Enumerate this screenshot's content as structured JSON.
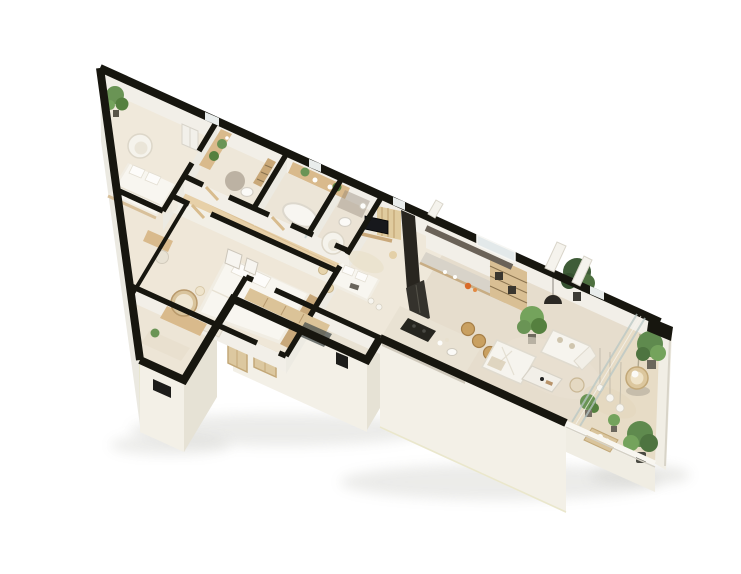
{
  "scene": {
    "kind": "isometric-3d-apartment-floor-plan-render",
    "background": "#ffffff"
  },
  "palette": {
    "wall_cut": "#17160f",
    "wall_face_light": "#f3f0e7",
    "wall_face_shade": "#e6e2d5",
    "wall_face_inner": "#f2efe8",
    "floor_cream": "#f0e9db",
    "floor_bath": "#ece5d7",
    "floor_living": "#e6ddcd",
    "floor_balcony": "#e7dcc6",
    "floor_corridor": "#e7d0a8",
    "wood_light": "#d9ba8c",
    "wood_door": "#dcc8a0",
    "wood_cabinet": "#d9bf94",
    "white_furniture": "#f6f4ee",
    "dark_appliance": "#34322c",
    "tv_screen": "#17181c",
    "plant_green": "#6a9455",
    "plant_dark": "#3f5c38",
    "accent_orange": "#d96a28",
    "glass": "#b9c7c5",
    "shadow": "#9a9a93"
  },
  "rooms": [
    {
      "id": "bedroom-apex",
      "furniture": [
        "double-bed",
        "armchair",
        "wardrobe",
        "plant"
      ]
    },
    {
      "id": "bathroom-1",
      "furniture": [
        "wood-vanity",
        "plants",
        "ladder-shelf",
        "wc",
        "stone-floor-mat"
      ]
    },
    {
      "id": "bathroom-2",
      "furniture": [
        "double-vanity",
        "plants",
        "bathtub",
        "glass-shower"
      ]
    },
    {
      "id": "wc",
      "furniture": [
        "toilet",
        "basin"
      ]
    },
    {
      "id": "corridor",
      "furniture": [
        "wood-plank-floor"
      ]
    },
    {
      "id": "bedroom-2",
      "furniture": [
        "double-bed",
        "headboard",
        "wall-art",
        "bench",
        "desk",
        "chair"
      ]
    },
    {
      "id": "dressing-hall",
      "furniture": [
        "console",
        "round-mirror",
        "runner-rug"
      ]
    },
    {
      "id": "entry-vestibule",
      "furniture": [
        "door-mat",
        "closet-row"
      ]
    },
    {
      "id": "master-bedroom",
      "furniture": [
        "media-wall",
        "tv",
        "slat-panel",
        "armchair",
        "bed",
        "rug",
        "floor-lamps"
      ]
    },
    {
      "id": "kitchen",
      "furniture": [
        "counter",
        "fridge",
        "tall-cabinets",
        "island",
        "cooktop",
        "bar-stools",
        "plant"
      ]
    },
    {
      "id": "living-room",
      "furniture": [
        "sofa",
        "l-sofa",
        "coffee-table",
        "side-table",
        "pendant-lamp",
        "tall-plant",
        "rug"
      ]
    },
    {
      "id": "balcony",
      "furniture": [
        "hanging-chair",
        "potted-plants",
        "string-bulbs",
        "low-table"
      ]
    }
  ]
}
